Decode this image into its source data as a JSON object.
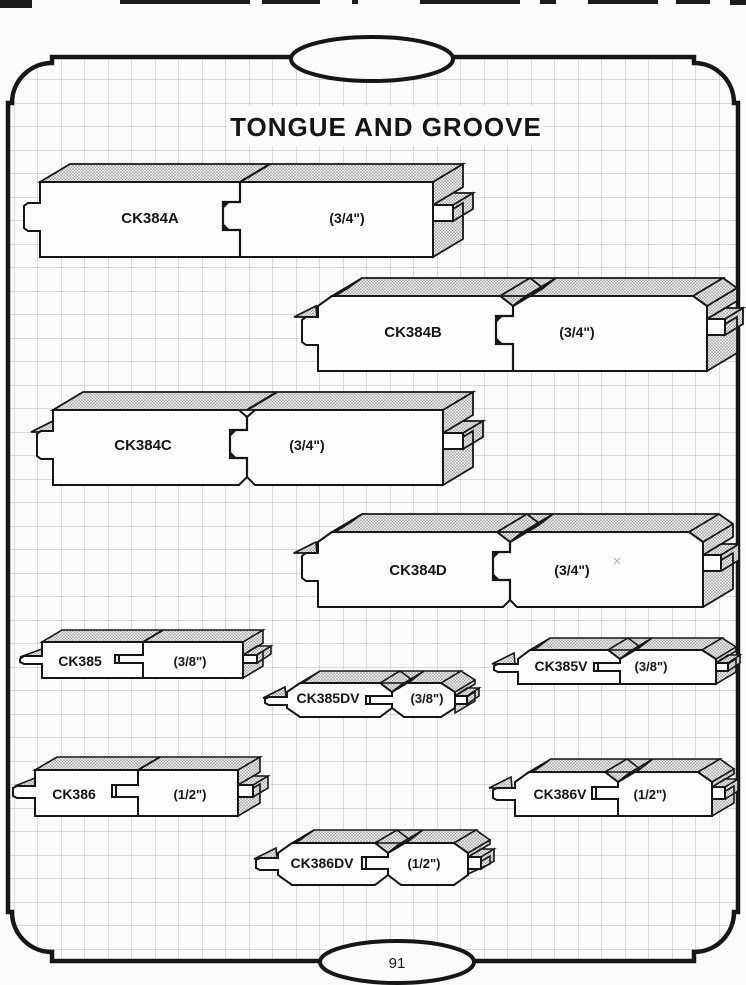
{
  "page": {
    "title": "TONGUE AND GROOVE",
    "page_number": "91"
  },
  "profiles": [
    {
      "code": "CK384A",
      "size": "(3/4\")"
    },
    {
      "code": "CK384B",
      "size": "(3/4\")"
    },
    {
      "code": "CK384C",
      "size": "(3/4\")"
    },
    {
      "code": "CK384D",
      "size": "(3/4\")"
    },
    {
      "code": "CK385",
      "size": "(3/8\")"
    },
    {
      "code": "CK385V",
      "size": "(3/8\")"
    },
    {
      "code": "CK385DV",
      "size": "(3/8\")"
    },
    {
      "code": "CK386",
      "size": "(1/2\")"
    },
    {
      "code": "CK386V",
      "size": "(1/2\")"
    },
    {
      "code": "CK386DV",
      "size": "(1/2\")"
    }
  ],
  "marks": {
    "stray_x": "×"
  },
  "colors": {
    "paper": "#fbfbf9",
    "ink": "#161616",
    "grid_line": "#b5bbb6",
    "stipple_dot": "#8a8a8a",
    "stipple_bg": "#ebebe8"
  }
}
